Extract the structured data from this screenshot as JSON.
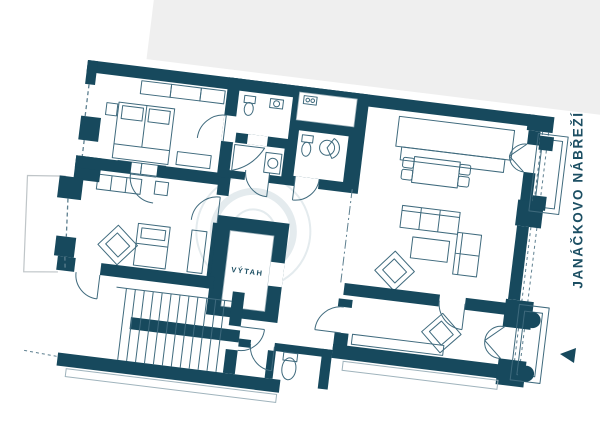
{
  "plan": {
    "labels": {
      "elevator": "VÝTAH",
      "street": "JANÁČKOVO NÁBŘEŽÍ"
    },
    "colors": {
      "wall": "#17495d",
      "furniture": "#3f6a7d",
      "neighbor_band": "#efefef",
      "outline_light": "#9fb3bc",
      "watermark": "#e4ebee",
      "dash": "#5d7f8f",
      "label": "#1c4f63",
      "room_fill": "#ffffff",
      "page_bg": "#ffffff"
    },
    "rotation_deg": 7
  }
}
